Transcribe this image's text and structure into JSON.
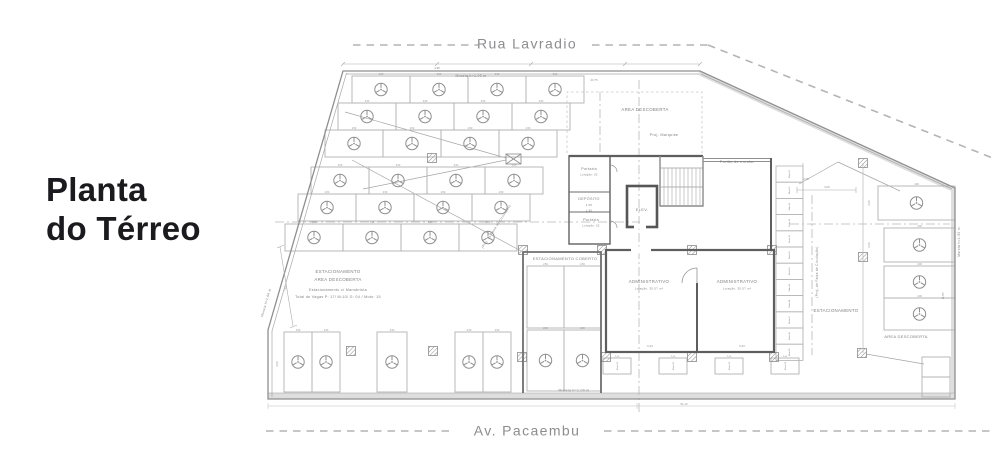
{
  "title": {
    "lines": [
      "Planta",
      "do Térreo"
    ]
  },
  "streets": {
    "top": "Rua Lavradio",
    "bottom": "Av. Pacaembu"
  },
  "plan": {
    "colors": {
      "line": "#b3b3b3",
      "boundary": "#8f8f8f",
      "wall": "#5e5e5e",
      "text": "#7f7f7f",
      "dim": "#8f8f8f",
      "band": "#dedede",
      "dash": "#b8b8b8",
      "mark": "#8f8f8f"
    },
    "stall_dim": "2,50",
    "stall_rows": [
      {
        "x": 352,
        "y": 76,
        "w": 58,
        "h": 27,
        "n": 4
      },
      {
        "x": 338,
        "y": 103,
        "w": 58,
        "h": 27,
        "n": 4
      },
      {
        "x": 325,
        "y": 130,
        "w": 58,
        "h": 27,
        "n": 4
      },
      {
        "x": 311,
        "y": 167,
        "w": 58,
        "h": 27,
        "n": 4
      },
      {
        "x": 298,
        "y": 194,
        "w": 58,
        "h": 27,
        "n": 4
      },
      {
        "x": 285,
        "y": 224,
        "w": 58,
        "h": 27,
        "n": 4
      }
    ],
    "stalls_v": [
      {
        "x": 284,
        "y": 332,
        "w": 28,
        "h": 60,
        "c": 1
      },
      {
        "x": 312,
        "y": 332,
        "w": 28,
        "h": 60,
        "c": 1
      },
      {
        "x": 377,
        "y": 332,
        "w": 30,
        "h": 60,
        "c": 1
      },
      {
        "x": 455,
        "y": 332,
        "w": 28,
        "h": 60,
        "c": 1
      },
      {
        "x": 483,
        "y": 332,
        "w": 28,
        "h": 60,
        "c": 1
      },
      {
        "x": 527,
        "y": 266,
        "w": 37,
        "h": 62,
        "c": 0
      },
      {
        "x": 564,
        "y": 266,
        "w": 37,
        "h": 62,
        "c": 0
      },
      {
        "x": 527,
        "y": 330,
        "w": 37,
        "h": 61,
        "c": 1
      },
      {
        "x": 564,
        "y": 330,
        "w": 37,
        "h": 61,
        "c": 1
      },
      {
        "x": 878,
        "y": 186,
        "w": 77,
        "h": 34,
        "c": 1,
        "d": "4,90"
      },
      {
        "x": 884,
        "y": 228,
        "w": 71,
        "h": 34,
        "c": 1,
        "d": "4,90"
      },
      {
        "x": 884,
        "y": 266,
        "w": 71,
        "h": 32,
        "c": 1,
        "d": "4,90"
      },
      {
        "x": 884,
        "y": 298,
        "w": 71,
        "h": 32,
        "c": 1,
        "d": "4,90"
      }
    ],
    "small_stalls": [
      [
        922,
        357,
        28,
        20
      ],
      [
        922,
        377,
        28,
        20
      ]
    ],
    "moto_bottom": {
      "xs": [
        603,
        659,
        715,
        771
      ],
      "y": 358,
      "w": 28,
      "h": 16,
      "dim": "2,00",
      "labels": [
        "Moto 01",
        "Moto 02",
        "Moto 03",
        "Moto 04"
      ]
    },
    "moto_right": {
      "x": 776,
      "y0": 166,
      "w": 27,
      "h": 16.2,
      "labels": [
        "Moto 16",
        "Moto 15",
        "Moto 14",
        "Moto 13",
        "Moto 12",
        "Moto 11",
        "Moto 10",
        "Moto 09",
        "Moto 08",
        "Moto 07",
        "Moto 06",
        "Moto 05"
      ]
    },
    "columns": [
      [
        432,
        158
      ],
      [
        523,
        250
      ],
      [
        602,
        250
      ],
      [
        692,
        250
      ],
      [
        772,
        250
      ],
      [
        351,
        351
      ],
      [
        433,
        351
      ],
      [
        522,
        357
      ],
      [
        606,
        357
      ],
      [
        692,
        357
      ],
      [
        774,
        357
      ],
      [
        863,
        163
      ],
      [
        863,
        257
      ],
      [
        862,
        353
      ]
    ],
    "leaders": [
      [
        345,
        112,
        506,
        158
      ],
      [
        363,
        189,
        506,
        160
      ],
      [
        352,
        160,
        521,
        251
      ],
      [
        838,
        162,
        799,
        184
      ],
      [
        838,
        162,
        900,
        191
      ],
      [
        866,
        354,
        924,
        364
      ]
    ],
    "dashdot": [
      [
        639,
        80,
        639,
        415
      ],
      [
        600,
        92,
        600,
        155
      ],
      [
        790,
        224,
        950,
        224
      ],
      [
        275,
        222,
        640,
        222
      ],
      [
        812,
        195,
        812,
        355
      ]
    ],
    "labels": [
      {
        "t": "AREA DESCOBERTA",
        "x": 645,
        "y": 111,
        "s": 4.4
      },
      {
        "t": "Proj. Marquise",
        "x": 664,
        "y": 136,
        "s": 3.8
      },
      {
        "t": "Portão de enrolar",
        "x": 737,
        "y": 163,
        "s": 3.8
      },
      {
        "t": "Portaria",
        "x": 589,
        "y": 170,
        "s": 3.8
      },
      {
        "t": "Lotação: 02",
        "x": 589,
        "y": 175.5,
        "s": 2.7
      },
      {
        "t": "DEPÓSITO",
        "x": 589,
        "y": 200,
        "s": 3.7
      },
      {
        "t": "2,05",
        "x": 589,
        "y": 206,
        "s": 2.7
      },
      {
        "t": "1,50",
        "x": 589,
        "y": 211.5,
        "s": 2.7
      },
      {
        "t": "Portaria",
        "x": 591,
        "y": 221,
        "s": 3.8
      },
      {
        "t": "Lotação: 02",
        "x": 591,
        "y": 226.5,
        "s": 2.7
      },
      {
        "t": "ELEV.",
        "x": 642,
        "y": 211,
        "s": 4
      },
      {
        "t": "ESTACIONAMENTO COBERTO",
        "x": 565,
        "y": 260,
        "s": 4
      },
      {
        "t": "ADMINISTRATIVO",
        "x": 649,
        "y": 283,
        "s": 4.3
      },
      {
        "t": "Lotação: 30,57 m²",
        "x": 649,
        "y": 289.5,
        "s": 2.9
      },
      {
        "t": "ADMINISTRATIVO",
        "x": 737,
        "y": 283,
        "s": 4.3
      },
      {
        "t": "Lotação: 30,57 m²",
        "x": 737,
        "y": 289.5,
        "s": 2.9
      },
      {
        "t": "ESTACIONAMENTO",
        "x": 338,
        "y": 273,
        "s": 4.4
      },
      {
        "t": "AREA DESCOBERTA",
        "x": 338,
        "y": 281,
        "s": 4.4
      },
      {
        "t": "Estacionamento c/ Manobrista",
        "x": 338,
        "y": 291,
        "s": 3.7
      },
      {
        "t": "Total de Vagas P: 17/ M:10/ G: 04 / Moto: 15",
        "x": 338,
        "y": 298,
        "s": 3.7
      },
      {
        "t": "ESTACIONAMENTO",
        "x": 836,
        "y": 312,
        "s": 4.4
      },
      {
        "t": "AREA DESCOBERTA",
        "x": 906,
        "y": 338,
        "s": 4
      },
      {
        "t": "Mureta h=1.00 m",
        "x": 471,
        "y": 77,
        "s": 3.5
      },
      {
        "t": "Mureta h=1.00 m",
        "x": 574,
        "y": 391.5,
        "s": 3.5
      },
      {
        "t": "Mureta h=1.00 m",
        "x": 960,
        "y": 242,
        "s": 3.3,
        "r": -90
      },
      {
        "t": "Mureta h=1.00 m",
        "x": 267,
        "y": 303,
        "s": 3.3,
        "r": -74
      },
      {
        "t": "(Proj. de Faixa de Circulação)",
        "x": 818,
        "y": 272,
        "s": 3.2,
        "r": -90
      },
      {
        "t": "(Proj. da Faixa de Circulação)",
        "x": 497,
        "y": 227,
        "s": 3.2,
        "r": -57
      }
    ],
    "dims": [
      {
        "t": "4,98",
        "x": 437,
        "y": 69
      },
      {
        "t": "23,75",
        "x": 594,
        "y": 81
      },
      {
        "t": "6,43",
        "x": 650,
        "y": 347
      },
      {
        "t": "5,43",
        "x": 742,
        "y": 347
      },
      {
        "t": "3,05",
        "x": 827,
        "y": 188
      },
      {
        "t": "2,05",
        "x": 806,
        "y": 180
      },
      {
        "t": "51,13",
        "x": 684,
        "y": 405
      },
      {
        "t": "7,18",
        "x": 286,
        "y": 289,
        "r": -74
      },
      {
        "t": "11,85",
        "x": 944,
        "y": 296,
        "r": -90
      },
      {
        "t": "3,00",
        "x": 278,
        "y": 364,
        "r": -90
      },
      {
        "t": "2,00",
        "x": 870,
        "y": 203,
        "r": -90
      },
      {
        "t": "2,00",
        "x": 870,
        "y": 245,
        "r": -90
      }
    ]
  }
}
